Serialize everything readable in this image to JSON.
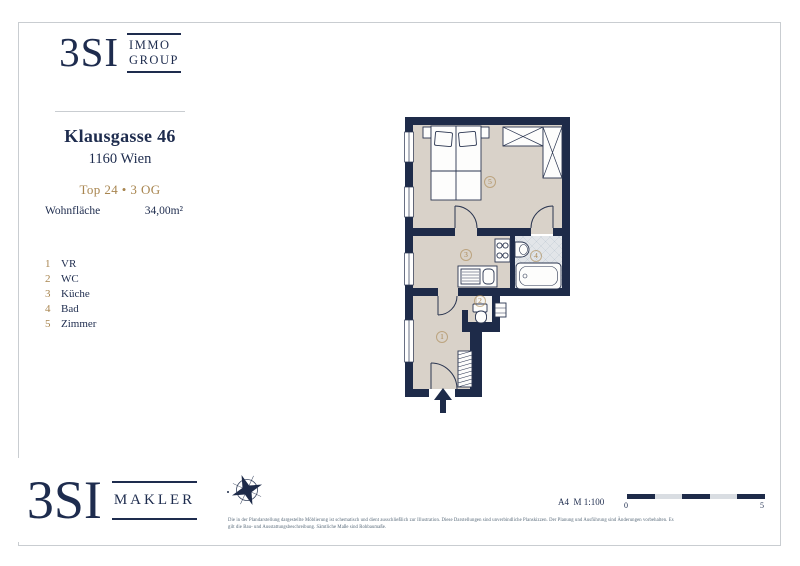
{
  "brand_top": {
    "mark": "3SI",
    "line1": "IMMO",
    "line2": "GROUP"
  },
  "property": {
    "street": "Klausgasse 46",
    "city": "1160 Wien",
    "unit": "Top 24 • 3 OG",
    "area_label": "Wohnfläche",
    "area_value": "34,00m²"
  },
  "legend": {
    "items": [
      {
        "num": "1",
        "label": "VR"
      },
      {
        "num": "2",
        "label": "WC"
      },
      {
        "num": "3",
        "label": "Küche"
      },
      {
        "num": "4",
        "label": "Bad"
      },
      {
        "num": "5",
        "label": "Zimmer"
      }
    ]
  },
  "plan": {
    "room_numbers": {
      "r1": "1",
      "r2": "2",
      "r3": "3",
      "r4": "4",
      "r5": "5"
    }
  },
  "footer": {
    "format_scale": "A4  M 1:100",
    "scale_start": "0",
    "scale_end": "5",
    "disclaimer_line1": "Die in der Plandarstellung dargestellte Möblierung ist schematisch und dient ausschließlich zur Illustration. Diese Darstellungen sind unverbindliche Planskizzen. Der Planung und Ausführung sind Änderungen vorbehalten. Es",
    "disclaimer_line2": "gilt die Bau- und Ausstattungsbeschreibung. Sämtliche Maße sind Rohbaumaße."
  },
  "brand_bottom": {
    "mark": "3SI",
    "suffix": "MAKLER"
  },
  "colors": {
    "navy": "#1e2b49",
    "gold": "#a8854f",
    "floor": "#d9d2c9",
    "tile": "#e2e5e9"
  }
}
